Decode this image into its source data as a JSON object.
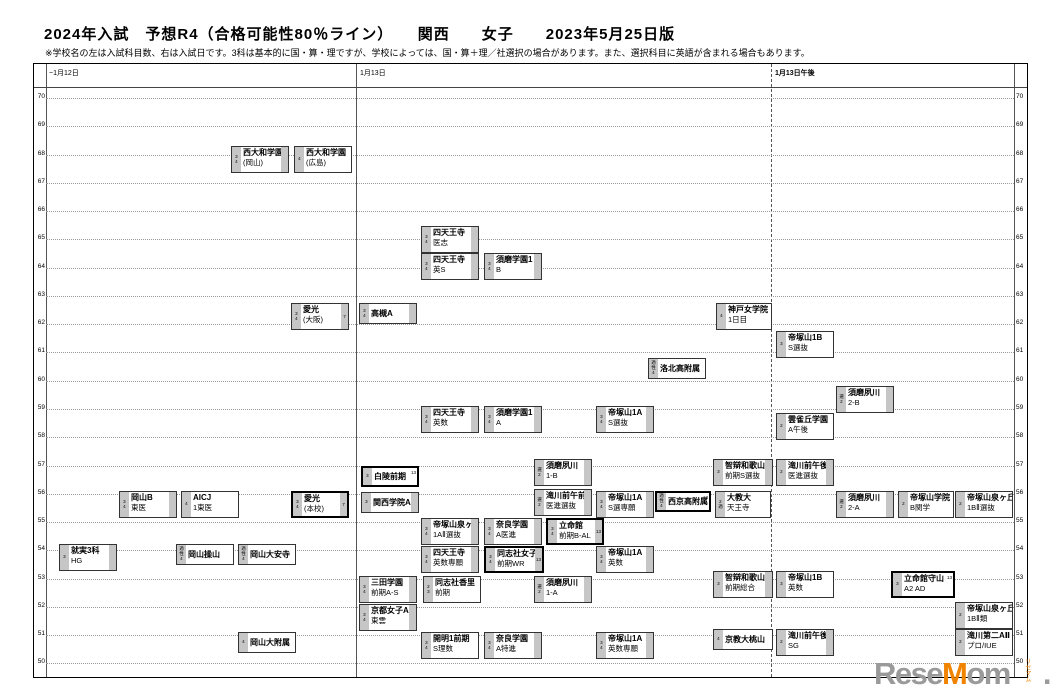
{
  "title": "2024年入試　予想R4（合格可能性80％ライン）　　関西　　女子　　2023年5月25日版",
  "note": "※学校名の左は入試科目数、右は入試日です。3科は基本的に国・算・理ですが、学校によっては、国・算＋理／社選択の場合があります。また、選択科目に英語が含まれる場合もあります。",
  "columns": [
    {
      "label": "~1月12日",
      "x": 15
    },
    {
      "label": "1月13日",
      "x": 326
    },
    {
      "label": "1月13日午後",
      "x": 741,
      "bold": true
    }
  ],
  "logo": {
    "part1": "Rese",
    "accent": "M",
    "part2": "om",
    "dot": ".",
    "vertical": "リセマム",
    "gray": "#9a9a9a",
    "orange": "#f08300"
  },
  "chart_data": {
    "type": "scatter",
    "title": "2024年入試 予想R4（合格可能性80％ライン） 関西 女子 2023年5月25日版",
    "xlabel": "入試日 (~1月12日 / 1月13日 / 1月13日午後)",
    "ylabel": "偏差値 R4（合格可能性80％ライン）",
    "ylim": [
      50,
      70
    ],
    "grid": true,
    "axis_values": [
      70,
      69,
      68,
      67,
      66,
      65,
      64,
      63,
      62,
      61,
      60,
      59,
      58,
      57,
      56,
      55,
      54,
      53,
      52,
      51,
      50
    ],
    "boxes": [
      {
        "n": "西大和学園",
        "s": "(岡山)",
        "l": [
          "3",
          "4"
        ],
        "r": "",
        "col": 0,
        "r4": 68,
        "x": 197,
        "y": 82,
        "w": 58,
        "b": false,
        "rb": true,
        "one": false
      },
      {
        "n": "西大和学園",
        "s": "(広島)",
        "l": [
          "4"
        ],
        "r": "",
        "col": 0,
        "r4": 68,
        "x": 260,
        "y": 82,
        "w": 58,
        "b": false,
        "rb": false,
        "one": false
      },
      {
        "n": "四天王寺",
        "s": "医志",
        "l": [
          "3",
          "4"
        ],
        "r": "",
        "col": 1,
        "r4": 65.5,
        "x": 387,
        "y": 162,
        "w": 58,
        "b": false,
        "rb": true,
        "one": false
      },
      {
        "n": "四天王寺",
        "s": "英S",
        "l": [
          "3",
          "4"
        ],
        "r": "",
        "col": 1,
        "r4": 64.5,
        "x": 387,
        "y": 189,
        "w": 58,
        "b": false,
        "rb": true,
        "one": false
      },
      {
        "n": "須磨学園1",
        "s": "B",
        "l": [
          "3",
          "4"
        ],
        "r": "",
        "col": 1,
        "r4": 64.5,
        "x": 450,
        "y": 189,
        "w": 58,
        "b": false,
        "rb": true,
        "one": false
      },
      {
        "n": "愛光",
        "s": "(大阪)",
        "l": [
          "3",
          "4"
        ],
        "r": "7",
        "col": 0,
        "r4": 63,
        "x": 257,
        "y": 239,
        "w": 58,
        "b": false,
        "rb": true,
        "one": false
      },
      {
        "n": "高槻A",
        "s": "",
        "l": [
          "3",
          "4"
        ],
        "r": "",
        "col": 1,
        "r4": 63,
        "x": 325,
        "y": 239,
        "w": 58,
        "b": false,
        "rb": true,
        "one": true
      },
      {
        "n": "神戸女学院",
        "s": "1日目",
        "l": [
          "4"
        ],
        "r": "",
        "col": 1,
        "r4": 63,
        "x": 682,
        "y": 239,
        "w": 56,
        "b": false,
        "rb": false,
        "one": false
      },
      {
        "n": "帝塚山1B",
        "s": "S選抜",
        "l": [
          "3"
        ],
        "r": "",
        "col": 2,
        "r4": 62,
        "x": 742,
        "y": 267,
        "w": 58,
        "b": false,
        "rb": false,
        "one": false
      },
      {
        "n": "洛北高附属",
        "s": "",
        "l": [
          "適",
          "性",
          "4"
        ],
        "r": "",
        "col": 1,
        "r4": 61,
        "x": 614,
        "y": 294,
        "w": 58,
        "b": false,
        "rb": false,
        "one": true
      },
      {
        "n": "須磨夙川",
        "s": "2-B",
        "l": [
          "選",
          "2"
        ],
        "r": "",
        "col": 2,
        "r4": 60,
        "x": 802,
        "y": 322,
        "w": 58,
        "b": false,
        "rb": true,
        "one": false
      },
      {
        "n": "四天王寺",
        "s": "英数",
        "l": [
          "3",
          "4"
        ],
        "r": "",
        "col": 1,
        "r4": 59,
        "x": 387,
        "y": 342,
        "w": 58,
        "b": false,
        "rb": true,
        "one": false
      },
      {
        "n": "須磨学園1",
        "s": "A",
        "l": [
          "3",
          "4"
        ],
        "r": "",
        "col": 1,
        "r4": 59,
        "x": 450,
        "y": 342,
        "w": 58,
        "b": false,
        "rb": true,
        "one": false
      },
      {
        "n": "帝塚山1A",
        "s": "S選抜",
        "l": [
          "3",
          "4"
        ],
        "r": "",
        "col": 1,
        "r4": 59,
        "x": 562,
        "y": 342,
        "w": 58,
        "b": false,
        "rb": true,
        "one": false
      },
      {
        "n": "雲雀丘学園",
        "s": "A午後",
        "l": [
          "2"
        ],
        "r": "",
        "col": 2,
        "r4": 59,
        "x": 742,
        "y": 349,
        "w": 58,
        "b": false,
        "rb": false,
        "one": false
      },
      {
        "n": "白陵前期",
        "s": "",
        "l": [
          "3"
        ],
        "r": "13",
        "col": 1,
        "r4": 57,
        "x": 327,
        "y": 402,
        "w": 58,
        "b": true,
        "rb": false,
        "one": true
      },
      {
        "n": "須磨夙川",
        "s": "1-B",
        "l": [
          "選",
          "2"
        ],
        "r": "",
        "col": 1,
        "r4": 57,
        "x": 500,
        "y": 395,
        "w": 58,
        "b": false,
        "rb": true,
        "one": false
      },
      {
        "n": "智辯和歌山",
        "s": "前期S選抜",
        "l": [
          "3"
        ],
        "r": "",
        "col": 1,
        "r4": 57,
        "x": 679,
        "y": 395,
        "w": 60,
        "b": false,
        "rb": true,
        "one": false
      },
      {
        "n": "滝川前午後",
        "s": "医進選抜",
        "l": [
          "2"
        ],
        "r": "",
        "col": 2,
        "r4": 57,
        "x": 742,
        "y": 395,
        "w": 58,
        "b": false,
        "rb": true,
        "one": false
      },
      {
        "n": "関西学院A",
        "s": "",
        "l": [
          "3"
        ],
        "r": "",
        "col": 1,
        "r4": 56,
        "x": 327,
        "y": 428,
        "w": 58,
        "b": false,
        "rb": true,
        "one": true
      },
      {
        "n": "岡山B",
        "s": "東医",
        "l": [
          "3",
          "4"
        ],
        "r": "",
        "col": 0,
        "r4": 56,
        "x": 85,
        "y": 427,
        "w": 58,
        "b": false,
        "rb": true,
        "one": false
      },
      {
        "n": "AICJ",
        "s": "1東医",
        "l": [
          "4"
        ],
        "r": "",
        "col": 0,
        "r4": 56,
        "x": 147,
        "y": 427,
        "w": 58,
        "b": false,
        "rb": false,
        "one": false
      },
      {
        "n": "愛光",
        "s": "(本校)",
        "l": [
          "3",
          "4"
        ],
        "r": "7",
        "col": 0,
        "r4": 56,
        "x": 257,
        "y": 427,
        "w": 58,
        "b": true,
        "rb": true,
        "one": false
      },
      {
        "n": "滝川前午前",
        "s": "医進選抜",
        "l": [
          "選",
          "2"
        ],
        "r": "",
        "col": 1,
        "r4": 56,
        "x": 500,
        "y": 425,
        "w": 58,
        "b": false,
        "rb": true,
        "one": false
      },
      {
        "n": "帝塚山1A",
        "s": "S選専願",
        "l": [
          "3",
          "4"
        ],
        "r": "",
        "col": 1,
        "r4": 56,
        "x": 562,
        "y": 427,
        "w": 58,
        "b": false,
        "rb": true,
        "one": false
      },
      {
        "n": "西京高附属",
        "s": "",
        "l": [
          "適",
          "性",
          "4"
        ],
        "r": "13",
        "col": 1,
        "r4": 56,
        "x": 621,
        "y": 427,
        "w": 56,
        "b": true,
        "rb": false,
        "one": true
      },
      {
        "n": "大教大",
        "s": "天王寺",
        "l": [
          "2",
          "適"
        ],
        "r": "",
        "col": 1,
        "r4": 56,
        "x": 681,
        "y": 427,
        "w": 56,
        "b": false,
        "rb": false,
        "one": false
      },
      {
        "n": "須磨夙川",
        "s": "2-A",
        "l": [
          "選",
          "2"
        ],
        "r": "",
        "col": 2,
        "r4": 56,
        "x": 802,
        "y": 427,
        "w": 58,
        "b": false,
        "rb": true,
        "one": false
      },
      {
        "n": "帝塚山学院",
        "s": "B関学",
        "l": [
          "2"
        ],
        "r": "",
        "col": 2,
        "r4": 56,
        "x": 864,
        "y": 427,
        "w": 56,
        "b": false,
        "rb": false,
        "one": false
      },
      {
        "n": "帝塚山泉ヶ丘",
        "s": "1BⅡ選抜",
        "l": [
          "2"
        ],
        "r": "",
        "col": 2,
        "r4": 56,
        "x": 921,
        "y": 427,
        "w": 58,
        "b": false,
        "rb": false,
        "one": false
      },
      {
        "n": "帝塚山泉ヶ丘",
        "s": "1AⅡ選抜",
        "l": [
          "3",
          "4"
        ],
        "r": "",
        "col": 1,
        "r4": 55,
        "x": 387,
        "y": 454,
        "w": 58,
        "b": false,
        "rb": true,
        "one": false
      },
      {
        "n": "奈良学園",
        "s": "A医進",
        "l": [
          "3",
          "4"
        ],
        "r": "",
        "col": 1,
        "r4": 55,
        "x": 450,
        "y": 454,
        "w": 58,
        "b": false,
        "rb": true,
        "one": false
      },
      {
        "n": "立命館",
        "s": "前期B-AL",
        "l": [
          "3",
          "4"
        ],
        "r": "13",
        "col": 1,
        "r4": 55,
        "x": 512,
        "y": 454,
        "w": 58,
        "b": true,
        "rb": true,
        "one": false
      },
      {
        "n": "就実3科",
        "s": "HG",
        "l": [
          "3"
        ],
        "r": "",
        "col": 0,
        "r4": 54,
        "x": 25,
        "y": 480,
        "w": 58,
        "b": false,
        "rb": true,
        "one": false
      },
      {
        "n": "岡山操山",
        "s": "",
        "l": [
          "適",
          "性",
          "4"
        ],
        "r": "",
        "col": 0,
        "r4": 54,
        "x": 142,
        "y": 480,
        "w": 58,
        "b": false,
        "rb": false,
        "one": true
      },
      {
        "n": "岡山大安寺",
        "s": "",
        "l": [
          "適",
          "性",
          "4"
        ],
        "r": "",
        "col": 0,
        "r4": 54,
        "x": 204,
        "y": 480,
        "w": 58,
        "b": false,
        "rb": false,
        "one": true
      },
      {
        "n": "四天王寺",
        "s": "英数専願",
        "l": [
          "3",
          "4"
        ],
        "r": "",
        "col": 1,
        "r4": 54,
        "x": 387,
        "y": 482,
        "w": 58,
        "b": false,
        "rb": true,
        "one": false
      },
      {
        "n": "同志社女子",
        "s": "前期WR",
        "l": [
          "3",
          "4"
        ],
        "r": "13",
        "col": 1,
        "r4": 54,
        "x": 450,
        "y": 482,
        "w": 60,
        "b": true,
        "rb": true,
        "one": false
      },
      {
        "n": "帝塚山1A",
        "s": "英数",
        "l": [
          "3",
          "4"
        ],
        "r": "",
        "col": 1,
        "r4": 54,
        "x": 562,
        "y": 482,
        "w": 58,
        "b": false,
        "rb": true,
        "one": false
      },
      {
        "n": "三田学園",
        "s": "前期A-S",
        "l": [
          "3",
          "4"
        ],
        "r": "",
        "col": 1,
        "r4": 53,
        "x": 325,
        "y": 512,
        "w": 58,
        "b": false,
        "rb": true,
        "one": false
      },
      {
        "n": "同志社香里",
        "s": "前期",
        "l": [
          "2",
          "3"
        ],
        "r": "",
        "col": 1,
        "r4": 53,
        "x": 389,
        "y": 512,
        "w": 58,
        "b": false,
        "rb": false,
        "one": false
      },
      {
        "n": "須磨夙川",
        "s": "1-A",
        "l": [
          "選",
          "2"
        ],
        "r": "",
        "col": 1,
        "r4": 53,
        "x": 500,
        "y": 512,
        "w": 58,
        "b": false,
        "rb": true,
        "one": false
      },
      {
        "n": "智辯和歌山",
        "s": "前期総合",
        "l": [
          "3"
        ],
        "r": "",
        "col": 1,
        "r4": 53,
        "x": 679,
        "y": 507,
        "w": 60,
        "b": false,
        "rb": true,
        "one": false
      },
      {
        "n": "帝塚山1B",
        "s": "英数",
        "l": [
          "3"
        ],
        "r": "",
        "col": 2,
        "r4": 53,
        "x": 742,
        "y": 507,
        "w": 58,
        "b": false,
        "rb": false,
        "one": false
      },
      {
        "n": "立命館守山",
        "s": "A2 AD",
        "l": [
          "3"
        ],
        "r": "13",
        "col": 2,
        "r4": 53,
        "x": 857,
        "y": 507,
        "w": 64,
        "b": true,
        "rb": false,
        "one": false
      },
      {
        "n": "京都女子A",
        "s": "東雲",
        "l": [
          "3",
          "4"
        ],
        "r": "",
        "col": 1,
        "r4": 52,
        "x": 325,
        "y": 540,
        "w": 58,
        "b": false,
        "rb": true,
        "one": false
      },
      {
        "n": "帝塚山泉ヶ丘",
        "s": "1BⅡ類",
        "l": [
          "2"
        ],
        "r": "",
        "col": 2,
        "r4": 52,
        "x": 921,
        "y": 538,
        "w": 58,
        "b": false,
        "rb": false,
        "one": false
      },
      {
        "n": "開明1前期",
        "s": "S理数",
        "l": [
          "3",
          "4"
        ],
        "r": "",
        "col": 1,
        "r4": 51,
        "x": 387,
        "y": 568,
        "w": 58,
        "b": false,
        "rb": false,
        "one": false
      },
      {
        "n": "奈良学園",
        "s": "A特進",
        "l": [
          "3",
          "4"
        ],
        "r": "",
        "col": 1,
        "r4": 51,
        "x": 450,
        "y": 568,
        "w": 58,
        "b": false,
        "rb": true,
        "one": false
      },
      {
        "n": "帝塚山1A",
        "s": "英数専願",
        "l": [
          "3",
          "4"
        ],
        "r": "",
        "col": 1,
        "r4": 51,
        "x": 562,
        "y": 568,
        "w": 58,
        "b": false,
        "rb": true,
        "one": false
      },
      {
        "n": "京教大桃山",
        "s": "",
        "l": [
          "4"
        ],
        "r": "",
        "col": 1,
        "r4": 51,
        "x": 679,
        "y": 565,
        "w": 60,
        "b": false,
        "rb": false,
        "one": true
      },
      {
        "n": "滝川前午後",
        "s": "SG",
        "l": [
          "2"
        ],
        "r": "",
        "col": 2,
        "r4": 51,
        "x": 742,
        "y": 565,
        "w": 58,
        "b": false,
        "rb": true,
        "one": false
      },
      {
        "n": "滝川第二AⅡ",
        "s": "プロ/IUE",
        "l": [
          "2"
        ],
        "r": "",
        "col": 2,
        "r4": 51,
        "x": 921,
        "y": 565,
        "w": 58,
        "b": false,
        "rb": false,
        "one": false
      },
      {
        "n": "岡山大附属",
        "s": "",
        "l": [
          "4"
        ],
        "r": "",
        "col": 0,
        "r4": 51,
        "x": 204,
        "y": 568,
        "w": 58,
        "b": false,
        "rb": false,
        "one": true
      }
    ]
  }
}
